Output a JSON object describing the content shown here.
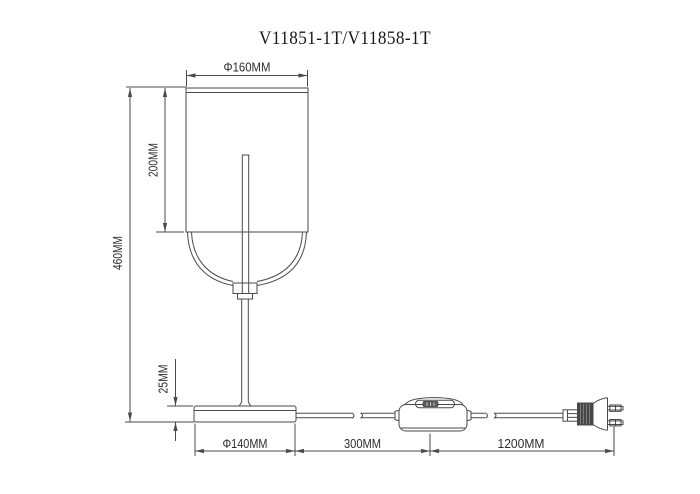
{
  "title": "V11851-1T/V11858-1T",
  "drawing": {
    "type": "technical-dimension-drawing",
    "subject": "table lamp with cylindrical shade, inline cord switch and euro plug",
    "dimensions": {
      "shade_diameter": "Φ160MM",
      "shade_height": "200MM",
      "total_height": "460MM",
      "base_height": "25MM",
      "base_diameter": "Φ140MM",
      "switch_distance": "300MM",
      "plug_distance": "1200MM"
    }
  },
  "colors": {
    "background": "#ffffff",
    "line": "#4a4a4a",
    "text": "#2e2e2e"
  }
}
